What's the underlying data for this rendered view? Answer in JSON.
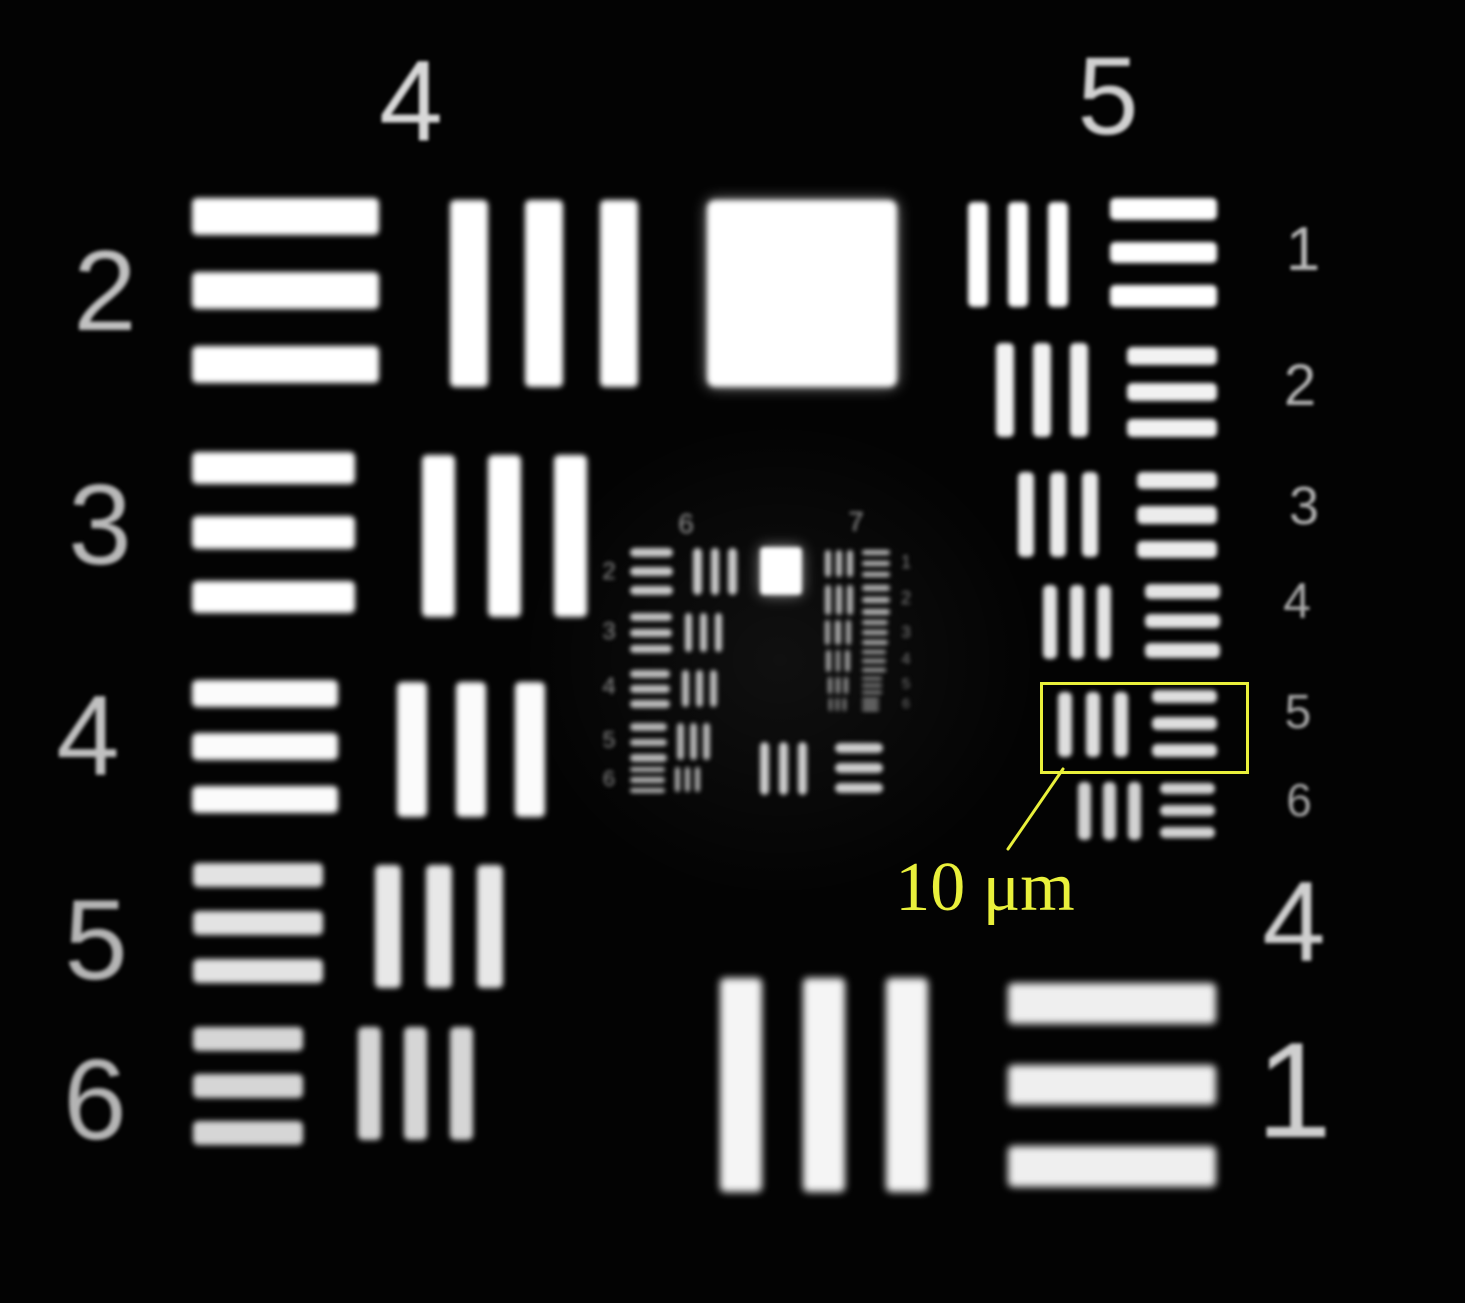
{
  "scene": {
    "description": "USAF 1951 resolution test target micrograph (grayscale, groups 4-7)",
    "background_color": "#030303",
    "bar_color": "#ffffff",
    "annotation_color": "#e9f03b"
  },
  "annotation": {
    "scale_label": "10 μm",
    "label_x": 985,
    "label_y": 888,
    "label_size": 70,
    "box": {
      "x": 1040,
      "y": 682,
      "w": 203,
      "h": 86,
      "border": 3
    },
    "line": {
      "x1": 1063,
      "y1": 769,
      "x2": 1008,
      "y2": 849
    }
  },
  "squares": [
    {
      "name": "big-square",
      "x": 707,
      "y": 200,
      "w": 190,
      "h": 187,
      "color": "#ffffff",
      "blur": 3,
      "radius": 8
    },
    {
      "name": "mini-square",
      "x": 760,
      "y": 547,
      "w": 42,
      "h": 48,
      "color": "#ffffff",
      "blur": 2,
      "radius": 4
    }
  ],
  "bar_patterns": [
    {
      "name": "g4-el2-hbars",
      "x": 192,
      "y": 198,
      "w": 187,
      "h": 185,
      "o": "h",
      "color": "#ffffff",
      "blur": 3
    },
    {
      "name": "g4-el2-vbars",
      "x": 450,
      "y": 200,
      "w": 188,
      "h": 187,
      "o": "v",
      "color": "#ffffff",
      "blur": 3
    },
    {
      "name": "g4-el3-hbars",
      "x": 192,
      "y": 452,
      "w": 163,
      "h": 161,
      "o": "h",
      "color": "#ffffff",
      "blur": 3
    },
    {
      "name": "g4-el3-vbars",
      "x": 422,
      "y": 455,
      "w": 165,
      "h": 162,
      "o": "v",
      "color": "#ffffff",
      "blur": 3
    },
    {
      "name": "g4-el4-hbars",
      "x": 192,
      "y": 680,
      "w": 146,
      "h": 133,
      "o": "h",
      "color": "#fbfbfb",
      "blur": 3
    },
    {
      "name": "g4-el4-vbars",
      "x": 397,
      "y": 682,
      "w": 148,
      "h": 135,
      "o": "v",
      "color": "#fbfbfb",
      "blur": 3
    },
    {
      "name": "g4-el5-hbars",
      "x": 193,
      "y": 863,
      "w": 130,
      "h": 120,
      "o": "h",
      "color": "#e3e3e3",
      "blur": 3
    },
    {
      "name": "g4-el5-vbars",
      "x": 375,
      "y": 865,
      "w": 128,
      "h": 123,
      "o": "v",
      "color": "#e8e8e8",
      "blur": 3
    },
    {
      "name": "g4-el6-hbars",
      "x": 193,
      "y": 1027,
      "w": 110,
      "h": 118,
      "o": "h",
      "color": "#d6d6d6",
      "blur": 3
    },
    {
      "name": "g4-el6-vbars",
      "x": 358,
      "y": 1027,
      "w": 115,
      "h": 113,
      "o": "v",
      "color": "#d6d6d6",
      "blur": 3
    },
    {
      "name": "g4-el1-vbars",
      "x": 720,
      "y": 978,
      "w": 208,
      "h": 214,
      "o": "v",
      "color": "#f5f5f5",
      "blur": 4
    },
    {
      "name": "g4-el1-hbars",
      "x": 1008,
      "y": 983,
      "w": 208,
      "h": 204,
      "o": "h",
      "color": "#efefef",
      "blur": 4
    },
    {
      "name": "g5-el1-vbars",
      "x": 968,
      "y": 202,
      "w": 100,
      "h": 105,
      "o": "v",
      "color": "#ffffff",
      "blur": 2.5
    },
    {
      "name": "g5-el1-hbars",
      "x": 1110,
      "y": 198,
      "w": 107,
      "h": 109,
      "o": "h",
      "color": "#ffffff",
      "blur": 2.5
    },
    {
      "name": "g5-el2-vbars",
      "x": 996,
      "y": 343,
      "w": 92,
      "h": 94,
      "o": "v",
      "color": "#f2f2f2",
      "blur": 2.5
    },
    {
      "name": "g5-el2-hbars",
      "x": 1127,
      "y": 347,
      "w": 90,
      "h": 90,
      "o": "h",
      "color": "#f2f2f2",
      "blur": 2.5
    },
    {
      "name": "g5-el3-vbars",
      "x": 1018,
      "y": 472,
      "w": 80,
      "h": 85,
      "o": "v",
      "color": "#ececec",
      "blur": 2.5
    },
    {
      "name": "g5-el3-hbars",
      "x": 1137,
      "y": 472,
      "w": 80,
      "h": 86,
      "o": "h",
      "color": "#ececec",
      "blur": 2.5
    },
    {
      "name": "g5-el4-vbars",
      "x": 1043,
      "y": 585,
      "w": 68,
      "h": 74,
      "o": "v",
      "color": "#e4e4e4",
      "blur": 2.5
    },
    {
      "name": "g5-el4-hbars",
      "x": 1145,
      "y": 584,
      "w": 75,
      "h": 74,
      "o": "h",
      "color": "#e4e4e4",
      "blur": 2.5
    },
    {
      "name": "g5-el5-vbars",
      "x": 1058,
      "y": 692,
      "w": 70,
      "h": 65,
      "o": "v",
      "color": "#dedede",
      "blur": 2.5
    },
    {
      "name": "g5-el5-hbars",
      "x": 1152,
      "y": 690,
      "w": 65,
      "h": 67,
      "o": "h",
      "color": "#dedede",
      "blur": 2.5
    },
    {
      "name": "g5-el6-vbars",
      "x": 1078,
      "y": 782,
      "w": 63,
      "h": 58,
      "o": "v",
      "color": "#d2d2d2",
      "blur": 2.5
    },
    {
      "name": "g5-el6-hbars",
      "x": 1160,
      "y": 783,
      "w": 55,
      "h": 55,
      "o": "h",
      "color": "#d2d2d2",
      "blur": 2.5
    },
    {
      "name": "g6-el2-hbars",
      "x": 630,
      "y": 548,
      "w": 43,
      "h": 47,
      "o": "h",
      "color": "#c8c8c8",
      "blur": 2.5
    },
    {
      "name": "g6-el2-vbars",
      "x": 693,
      "y": 548,
      "w": 44,
      "h": 47,
      "o": "v",
      "color": "#c8c8c8",
      "blur": 2.5
    },
    {
      "name": "g6-el3-hbars",
      "x": 630,
      "y": 613,
      "w": 42,
      "h": 40,
      "o": "h",
      "color": "#c2c2c2",
      "blur": 2.5
    },
    {
      "name": "g6-el3-vbars",
      "x": 685,
      "y": 613,
      "w": 37,
      "h": 39,
      "o": "v",
      "color": "#c2c2c2",
      "blur": 2.5
    },
    {
      "name": "g6-el4-hbars",
      "x": 630,
      "y": 670,
      "w": 40,
      "h": 38,
      "o": "h",
      "color": "#bcbcbc",
      "blur": 2.5
    },
    {
      "name": "g6-el4-vbars",
      "x": 682,
      "y": 670,
      "w": 35,
      "h": 37,
      "o": "v",
      "color": "#bcbcbc",
      "blur": 2.5
    },
    {
      "name": "g6-el5-hbars",
      "x": 630,
      "y": 723,
      "w": 37,
      "h": 39,
      "o": "h",
      "color": "#b6b6b6",
      "blur": 2.5
    },
    {
      "name": "g6-el5-vbars",
      "x": 677,
      "y": 723,
      "w": 33,
      "h": 37,
      "o": "v",
      "color": "#b6b6b6",
      "blur": 2.5
    },
    {
      "name": "g6-el6-hbars",
      "x": 630,
      "y": 767,
      "w": 35,
      "h": 26,
      "o": "h",
      "color": "#b0b0b0",
      "blur": 2.5
    },
    {
      "name": "g6-el6-vbars",
      "x": 675,
      "y": 767,
      "w": 25,
      "h": 25,
      "o": "v",
      "color": "#b0b0b0",
      "blur": 2.5
    },
    {
      "name": "g6-el1-vbars",
      "x": 760,
      "y": 742,
      "w": 47,
      "h": 53,
      "o": "v",
      "color": "#cccccc",
      "blur": 2.5
    },
    {
      "name": "g6-el1-hbars",
      "x": 835,
      "y": 743,
      "w": 48,
      "h": 50,
      "o": "h",
      "color": "#cccccc",
      "blur": 2.5
    },
    {
      "name": "g7-el1-vbars",
      "x": 825,
      "y": 550,
      "w": 28,
      "h": 27,
      "o": "v",
      "color": "#bbbbbb",
      "blur": 2.5
    },
    {
      "name": "g7-el1-hbars",
      "x": 862,
      "y": 550,
      "w": 28,
      "h": 27,
      "o": "h",
      "color": "#bbbbbb",
      "blur": 2.5
    },
    {
      "name": "g7-el2-vbars",
      "x": 825,
      "y": 585,
      "w": 28,
      "h": 30,
      "o": "v",
      "color": "#b4b4b4",
      "blur": 2.5
    },
    {
      "name": "g7-el2-hbars",
      "x": 862,
      "y": 585,
      "w": 28,
      "h": 30,
      "o": "h",
      "color": "#b4b4b4",
      "blur": 2.5
    },
    {
      "name": "g7-el3-vbars",
      "x": 825,
      "y": 620,
      "w": 26,
      "h": 25,
      "o": "v",
      "color": "#ababab",
      "blur": 2.5
    },
    {
      "name": "g7-el3-hbars",
      "x": 862,
      "y": 620,
      "w": 26,
      "h": 25,
      "o": "h",
      "color": "#ababab",
      "blur": 2.5
    },
    {
      "name": "g7-el4-vbars",
      "x": 826,
      "y": 650,
      "w": 24,
      "h": 22,
      "o": "v",
      "color": "#a2a2a2",
      "blur": 2.5
    },
    {
      "name": "g7-el4-hbars",
      "x": 862,
      "y": 650,
      "w": 24,
      "h": 22,
      "o": "h",
      "color": "#a2a2a2",
      "blur": 2.5
    },
    {
      "name": "g7-el5-vbars",
      "x": 828,
      "y": 677,
      "w": 20,
      "h": 17,
      "o": "v",
      "color": "#9a9a9a",
      "blur": 2.5
    },
    {
      "name": "g7-el5-hbars",
      "x": 862,
      "y": 677,
      "w": 20,
      "h": 17,
      "o": "h",
      "color": "#9a9a9a",
      "blur": 2.5
    },
    {
      "name": "g7-el6-vbars",
      "x": 829,
      "y": 698,
      "w": 17,
      "h": 13,
      "o": "v",
      "color": "#929292",
      "blur": 2.5
    },
    {
      "name": "g7-el6-hbars",
      "x": 862,
      "y": 698,
      "w": 17,
      "h": 13,
      "o": "h",
      "color": "#929292",
      "blur": 2.5
    }
  ],
  "labels": [
    {
      "name": "group-4-label-top",
      "text": "4",
      "x": 411,
      "y": 102,
      "size": 115,
      "color": "#d8d8d8",
      "blur": 1.6
    },
    {
      "name": "group-5-label-top",
      "text": "5",
      "x": 1108,
      "y": 97,
      "size": 110,
      "color": "#d0d0d0",
      "blur": 1.6
    },
    {
      "name": "g4-el2-number",
      "text": "2",
      "x": 105,
      "y": 292,
      "size": 114,
      "color": "#c0c0c0",
      "blur": 1.8
    },
    {
      "name": "g4-el3-number",
      "text": "3",
      "x": 100,
      "y": 526,
      "size": 114,
      "color": "#b8b8b8",
      "blur": 1.8
    },
    {
      "name": "g4-el4-number",
      "text": "4",
      "x": 88,
      "y": 737,
      "size": 114,
      "color": "#c0c0c0",
      "blur": 1.8
    },
    {
      "name": "g4-el5-number",
      "text": "5",
      "x": 96,
      "y": 941,
      "size": 114,
      "color": "#b4b4b4",
      "blur": 1.8
    },
    {
      "name": "g4-el6-number",
      "text": "6",
      "x": 95,
      "y": 1101,
      "size": 114,
      "color": "#b4b4b4",
      "blur": 1.8
    },
    {
      "name": "g5-el1-number",
      "text": "1",
      "x": 1303,
      "y": 250,
      "size": 62,
      "color": "#b8b8b8",
      "blur": 1.5
    },
    {
      "name": "g5-el2-number",
      "text": "2",
      "x": 1300,
      "y": 386,
      "size": 58,
      "color": "#b4b4b4",
      "blur": 1.5
    },
    {
      "name": "g5-el3-number",
      "text": "3",
      "x": 1304,
      "y": 506,
      "size": 54,
      "color": "#b0b0b0",
      "blur": 1.5
    },
    {
      "name": "g5-el4-number",
      "text": "4",
      "x": 1297,
      "y": 601,
      "size": 50,
      "color": "#ababab",
      "blur": 1.5
    },
    {
      "name": "g5-el5-number",
      "text": "5",
      "x": 1298,
      "y": 713,
      "size": 48,
      "color": "#a8a8a8",
      "blur": 1.5
    },
    {
      "name": "g5-el6-number",
      "text": "6",
      "x": 1299,
      "y": 800,
      "size": 46,
      "color": "#a4a4a4",
      "blur": 1.5
    },
    {
      "name": "group-4-label-bottom",
      "text": "4",
      "x": 1294,
      "y": 923,
      "size": 114,
      "color": "#cfcfcf",
      "blur": 1.8
    },
    {
      "name": "g4-el1-number",
      "text": "1",
      "x": 1294,
      "y": 1090,
      "size": 136,
      "color": "#cfcfcf",
      "blur": 1.8
    },
    {
      "name": "group-6-label-top",
      "text": "6",
      "x": 686,
      "y": 524,
      "size": 28,
      "color": "#9a9a9a",
      "blur": 2
    },
    {
      "name": "group-7-label-top",
      "text": "7",
      "x": 856,
      "y": 522,
      "size": 28,
      "color": "#9a9a9a",
      "blur": 2
    },
    {
      "name": "g6-el2-number",
      "text": "2",
      "x": 609,
      "y": 572,
      "size": 24,
      "color": "#8e8e8e",
      "blur": 2
    },
    {
      "name": "g6-el3-number",
      "text": "3",
      "x": 609,
      "y": 632,
      "size": 24,
      "color": "#8e8e8e",
      "blur": 2
    },
    {
      "name": "g6-el4-number",
      "text": "4",
      "x": 609,
      "y": 687,
      "size": 24,
      "color": "#8e8e8e",
      "blur": 2
    },
    {
      "name": "g6-el5-number",
      "text": "5",
      "x": 609,
      "y": 740,
      "size": 23,
      "color": "#8a8a8a",
      "blur": 2
    },
    {
      "name": "g6-el6-number",
      "text": "6",
      "x": 609,
      "y": 779,
      "size": 22,
      "color": "#8a8a8a",
      "blur": 2
    },
    {
      "name": "g7-el1-number",
      "text": "1",
      "x": 906,
      "y": 562,
      "size": 18,
      "color": "#848484",
      "blur": 2
    },
    {
      "name": "g7-el2-number",
      "text": "2",
      "x": 906,
      "y": 598,
      "size": 18,
      "color": "#848484",
      "blur": 2
    },
    {
      "name": "g7-el3-number",
      "text": "3",
      "x": 906,
      "y": 632,
      "size": 17,
      "color": "#808080",
      "blur": 2
    },
    {
      "name": "g7-el4-number",
      "text": "4",
      "x": 906,
      "y": 660,
      "size": 16,
      "color": "#7c7c7c",
      "blur": 2
    },
    {
      "name": "g7-el5-number",
      "text": "5",
      "x": 906,
      "y": 684,
      "size": 15,
      "color": "#787878",
      "blur": 2
    },
    {
      "name": "g7-el6-number",
      "text": "6",
      "x": 906,
      "y": 703,
      "size": 14,
      "color": "#747474",
      "blur": 2
    }
  ]
}
